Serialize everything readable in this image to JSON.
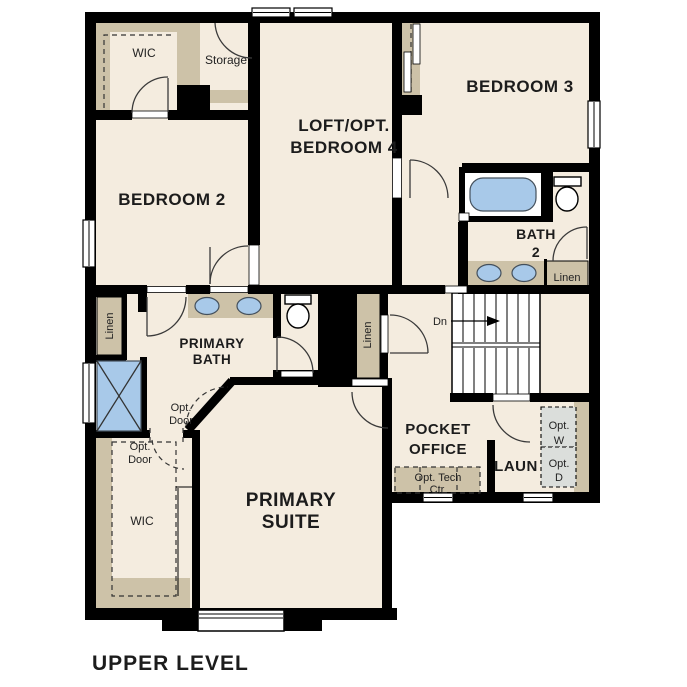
{
  "page": {
    "title": "UPPER LEVEL"
  },
  "colors": {
    "background": "#ffffff",
    "walls": "#000000",
    "room_fill": "#f4ecdf",
    "closet_tan": "#cdc2a8",
    "fixture_blue": "#a8c9e9",
    "appliance_gray": "#dbdedb",
    "text": "#1c1c1c"
  },
  "rooms": {
    "bedroom2": {
      "label": "BEDROOM 2"
    },
    "bedroom3": {
      "label": "BEDROOM 3"
    },
    "loft": {
      "label_line1": "LOFT/OPT.",
      "label_line2": "BEDROOM 4"
    },
    "primary_suite": {
      "label_line1": "PRIMARY",
      "label_line2": "SUITE"
    },
    "primary_bath": {
      "label_line1": "PRIMARY",
      "label_line2": "BATH"
    },
    "bath2": {
      "label_line1": "BATH",
      "label_line2": "2"
    },
    "pocket_office": {
      "label_line1": "POCKET",
      "label_line2": "OFFICE"
    },
    "laundry": {
      "label": "LAUN"
    }
  },
  "closets": {
    "wic_bedroom2": "WIC",
    "wic_primary": "WIC",
    "storage": "Storage",
    "linen_left": "Linen",
    "linen_middle": "Linen",
    "linen_right": "Linen"
  },
  "annotations": {
    "stairs_down": "Dn",
    "opt_door_bath": {
      "line1": "Opt.",
      "line2": "Door"
    },
    "opt_door_wic": {
      "line1": "Opt.",
      "line2": "Door"
    },
    "opt_washer": {
      "line1": "Opt.",
      "line2": "W"
    },
    "opt_dryer": {
      "line1": "Opt.",
      "line2": "D"
    },
    "opt_tech_center": {
      "line1": "Opt. Tech",
      "line2": "Ctr"
    }
  }
}
